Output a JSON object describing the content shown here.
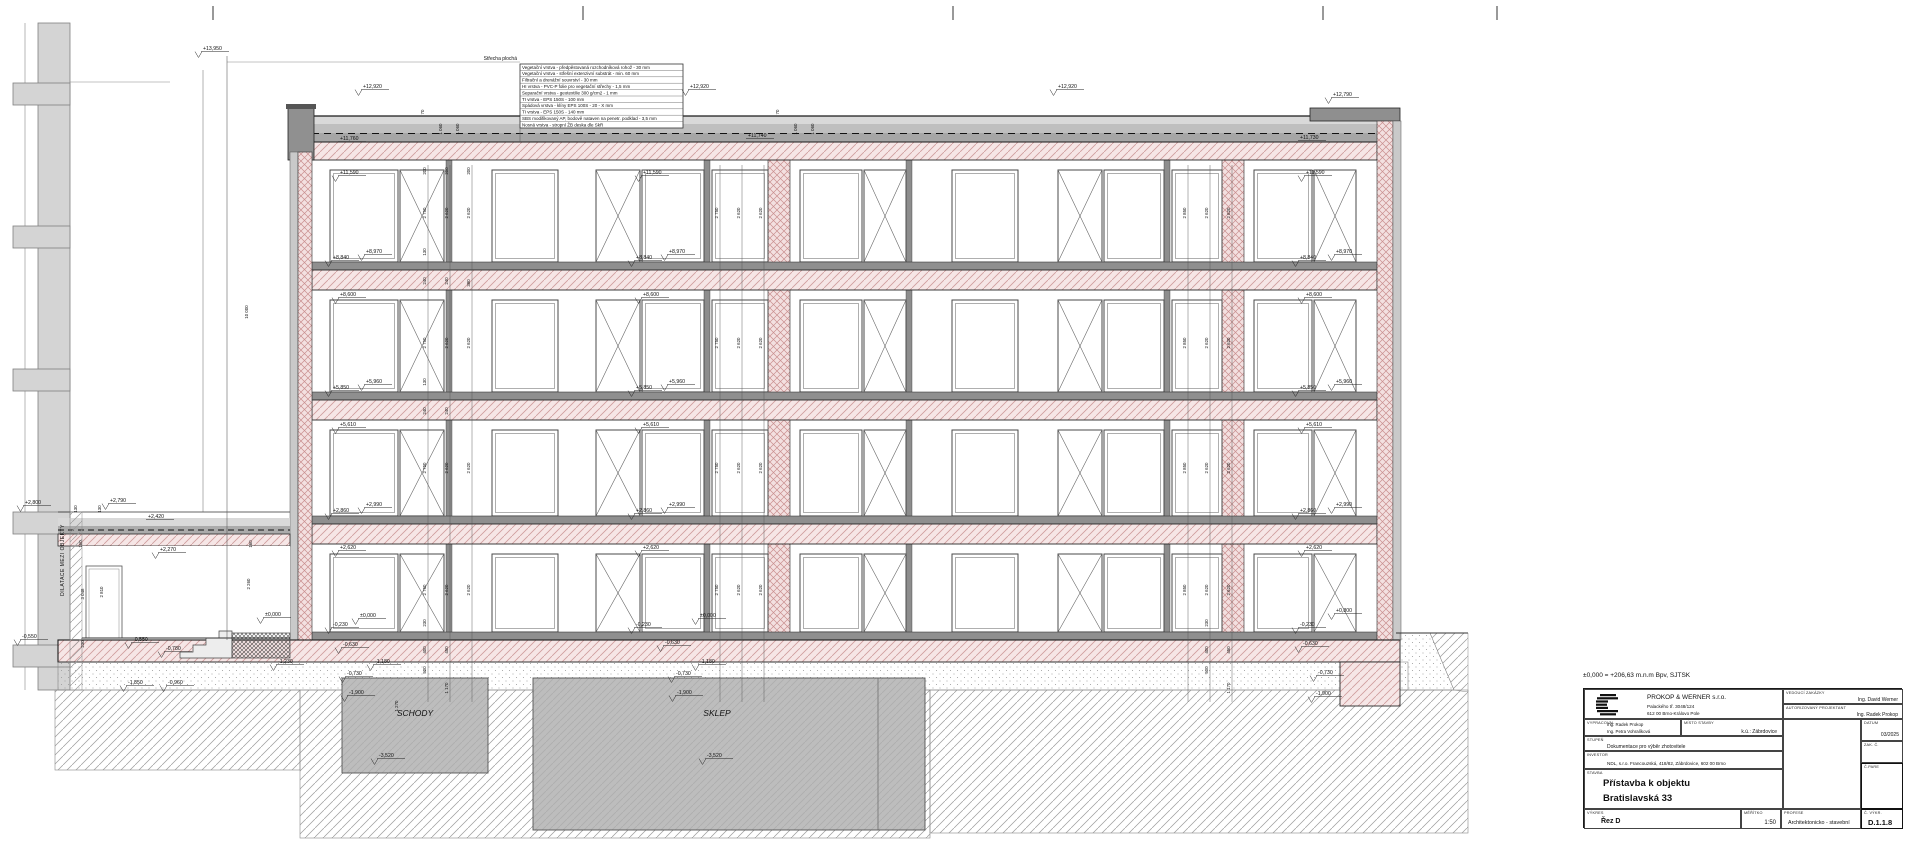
{
  "sheet": {
    "datum_note": "±0,000 = +206,63 m.n.m Bpv, SJTSK"
  },
  "roof_legend": {
    "title": "Střecha plochá",
    "layers": [
      "Vegetační vrstva - předpěstovaná rozchodníková rohož - 30 mm",
      "Vegetační vrstva - střešní extenzivní substrát - min. 60 mm",
      "Filtrační a drenážní souvrství - 30 mm",
      "HI vrstva - PVC-P folie pro vegetační střechy - 1,5 mm",
      "Separační vrstva - geotextilie 300 g/cm2 - 1 mm",
      "TI vrstva - EPS 150S - 100 mm",
      "Spádová vrstva - klíny EPS 100S - 20 - X mm",
      "TI vrstva - EPS 150S - 140 mm",
      "SBS modifikovaný AP, bodově nataven na penetr. podklad - 3,5 mm",
      "Nosná vrstva - stropní ŽB deska dle SkR"
    ]
  },
  "room_labels": {
    "schody": "SCHODY",
    "sklep": "SKLEP",
    "dilatace": "DILATACE MEZI OBJEKTY"
  },
  "elevations": {
    "p13950": "+13,950",
    "p12920": "+12,920",
    "p12790": "+12,790",
    "p11760": "+11,760",
    "p11740": "+11,740",
    "p11730": "+11,730",
    "p11590": "+11,590",
    "p8970": "+8,970",
    "p8840": "+8,840",
    "p8600": "+8,600",
    "p5960": "+5,960",
    "p5850": "+5,850",
    "p5610": "+5,610",
    "p2990": "+2,990",
    "p2860": "+2,860",
    "p2800": "+2,800",
    "p2790": "+2,790",
    "p2620": "+2,620",
    "p2420": "+2,420",
    "p2270": "+2,270",
    "p0800": "+0,800",
    "zero": "±0,000",
    "m0230": "-0,230",
    "m0550": "-0,550",
    "m0630": "-0,630",
    "m0730": "-0,730",
    "m0780": "-0,780",
    "m0960": "-0,960",
    "m1180": "-1,180",
    "m1230": "-1,230",
    "m1850": "-1,850",
    "m1900": "-1,900",
    "m3520": "-3,520"
  },
  "dimensions": {
    "d10000": "10 000",
    "d3048": "3 048",
    "d2850": "2 850",
    "d2810": "2 810",
    "d2750": "2 750",
    "d2620": "2 620",
    "d2260": "2 260",
    "d1270": "1 270",
    "d1170": "1 170",
    "d1060": "1 060",
    "d500": "500",
    "d450": "450",
    "d400": "400",
    "d380": "380",
    "d240": "240",
    "d230": "230",
    "d200": "200",
    "d160": "160",
    "d130": "130",
    "d70": "70"
  },
  "titleblock": {
    "company": {
      "name": "PROKOP & WERNER s.r.o.",
      "address1": "Palackého tř. 3048/124",
      "address2": "612 00 Brno-Královo Pole"
    },
    "fields": {
      "vedouci_zakazky": {
        "label": "VEDOUCÍ ZAKÁZKY",
        "value": "Ing. David Werner"
      },
      "autorizovany_projektant": {
        "label": "AUTORIZOVANÝ PROJEKTANT",
        "value": "Ing. Radek Prokop"
      },
      "vypracoval": {
        "label": "VYPRACOVAL",
        "value1": "Ing. Radek Prokop",
        "value2": "Ing. Petra Vohralíková"
      },
      "misto_stavby": {
        "label": "MÍSTO STAVBY",
        "value": "k.ú.: Zábrdovice"
      },
      "datum": {
        "label": "DATUM",
        "value": "03/2025"
      },
      "stupen": {
        "label": "STUPEŇ",
        "value": "Dokumentace pro výběr zhotovitele"
      },
      "zak_c": {
        "label": "ZAK. Č.",
        "value": ""
      },
      "investor": {
        "label": "INVESTOR",
        "value": "NDL, s.r.o. Francouzská, 418/82, Zábrdovice, 602 00 Brno"
      },
      "c_pare": {
        "label": "Č.PARE",
        "value": ""
      },
      "stavba": {
        "label": "STAVBA",
        "line1": "Přístavba k objektu",
        "line2": "Bratislavská 33"
      },
      "vykres": {
        "label": "VÝKRES",
        "value": "Řez D"
      },
      "meritko": {
        "label": "MĚŘÍTKO",
        "value": "1:50"
      },
      "profese": {
        "label": "PROFESE",
        "value": "Architektonicko - stavební"
      },
      "c_vykr": {
        "label": "Č. VÝKR.",
        "value": "D.1.1.8"
      }
    }
  }
}
